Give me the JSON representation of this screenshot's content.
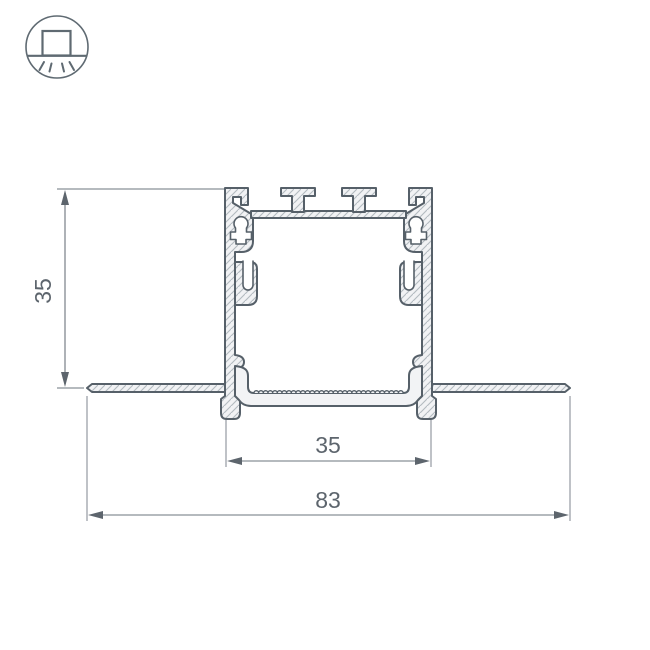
{
  "drawing": {
    "title": "recessed-led-profile-cross-section",
    "icon_badge": "recessed-mounting-icon",
    "dimensions": {
      "height": {
        "value": "35",
        "orientation": "vertical"
      },
      "body_width": {
        "value": "35",
        "orientation": "horizontal"
      },
      "overall_width": {
        "value": "83",
        "orientation": "horizontal"
      }
    },
    "colors": {
      "outline": "#566069",
      "hatch": "#b3bac0",
      "fill": "#f1f2f4",
      "dimension_lines": "#6b747c",
      "text": "#5d656d",
      "background": "#ffffff"
    }
  }
}
